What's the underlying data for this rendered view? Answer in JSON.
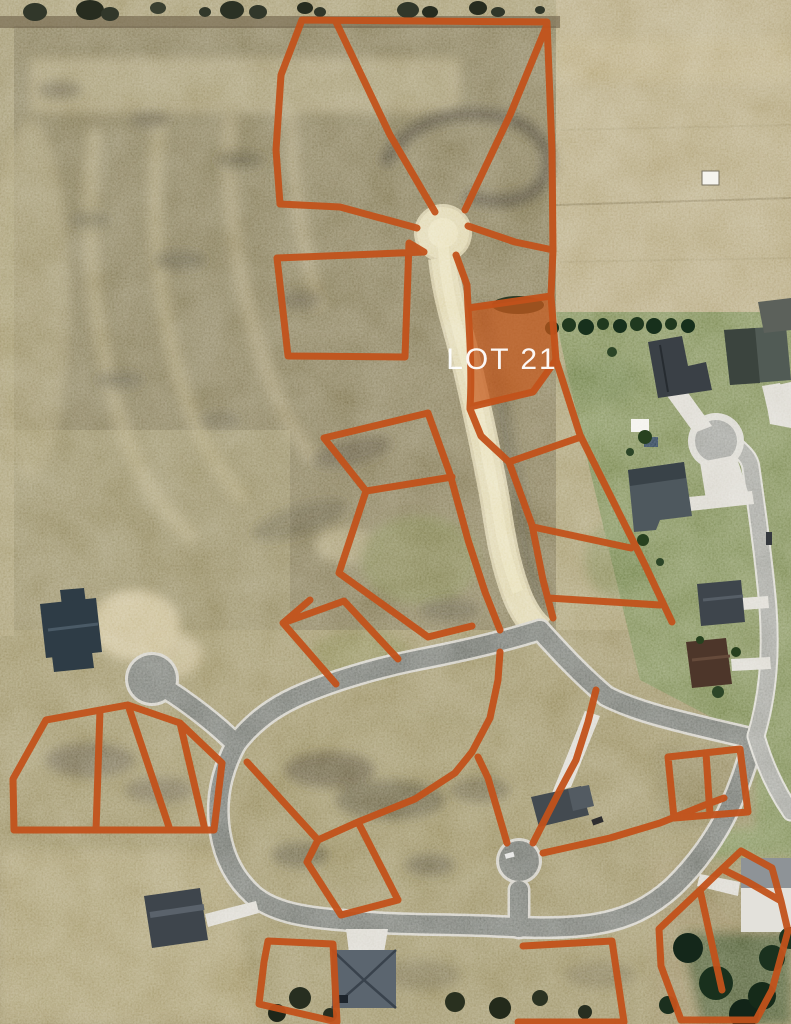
{
  "map": {
    "lot_label": "LOT 21",
    "highlighted_lot": "LOT 21",
    "colors": {
      "lot_line": "#c2521b",
      "lot_fill": "#c65a1d",
      "label_text": "#ffffff",
      "dirt_road": "#ddd3a9",
      "asphalt": "#73766f",
      "asphalt_edge": "#cfccc2",
      "existing_road": "#a0a19a",
      "concrete": "#d6d4cb",
      "field_tan": "#9c9168",
      "field_olive": "#847a57",
      "field_light": "#b2a47b",
      "lawn_green": "#7b8953",
      "conifer_green": "#17301c"
    }
  }
}
